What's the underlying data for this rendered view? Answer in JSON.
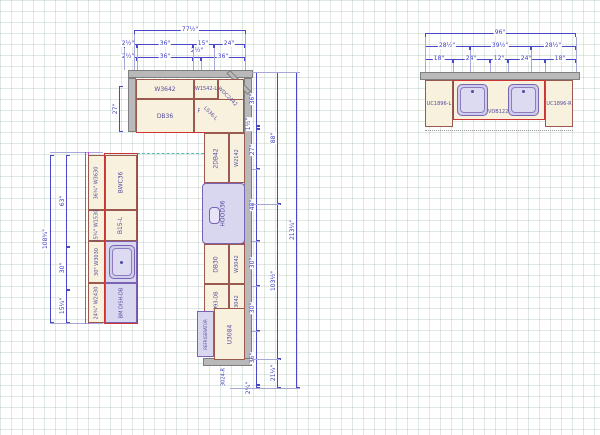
{
  "l_run": {
    "dim_total": "77½\"",
    "dim_row2": [
      "2½\"",
      "36\"",
      "15\"",
      "24\""
    ],
    "dim_row3": [
      "2½\"",
      "36\"",
      "2½\"",
      "36\""
    ],
    "dim_left": "27\"",
    "cabinets": {
      "wall1": "W3642",
      "wall2": "W1542-L",
      "base1": "DB36",
      "filler": "F",
      "corner_wall": "WDC2442",
      "corner_base": "LS36-L"
    }
  },
  "tall_run": {
    "row_a": {
      "base": "2DB42",
      "wall": "W2142"
    },
    "hood": "HOOD36",
    "row_c": {
      "base": "DB30",
      "wall": "W3042"
    },
    "row_d": {
      "base": "B3993-DB",
      "wall": "W3042"
    },
    "refrigerator": "REFRIGERATOR",
    "tall_cabinet": "U3084",
    "tall_note": "3024-R",
    "dims_inner": [
      "36\"",
      "1½\"",
      "27\"",
      "48\"",
      "30\"",
      "30\"",
      "36\"",
      "2¼\""
    ],
    "dims_middle": [
      "88\"",
      "103½\"",
      "21¼\""
    ],
    "dim_total": "213¼\""
  },
  "island_run": {
    "strip": [
      {
        "dim": "36¾\"",
        "label": "W3630"
      },
      {
        "dim": "15¾\"",
        "label": "W1530"
      },
      {
        "dim": "30\"",
        "label": "W3030"
      },
      {
        "dim": "24¾\"",
        "label": "W2430"
      }
    ],
    "cab1": "BWC36",
    "cab2": "B15-L",
    "dish": "BM DISH-DB",
    "dims_middle": [
      "63\"",
      "30\"",
      "15¼\""
    ],
    "dim_total": "108¾\""
  },
  "vanity_run": {
    "dim_total": "96\"",
    "dims_mid": [
      "28½\"",
      "39½\"",
      "28½\""
    ],
    "dims_inner": [
      "18\"",
      "24\"",
      "12\"",
      "24\"",
      "18\""
    ],
    "cab_left": "UC1896-L",
    "cab_center": "VDB122",
    "cab_right": "UC1896-R"
  }
}
